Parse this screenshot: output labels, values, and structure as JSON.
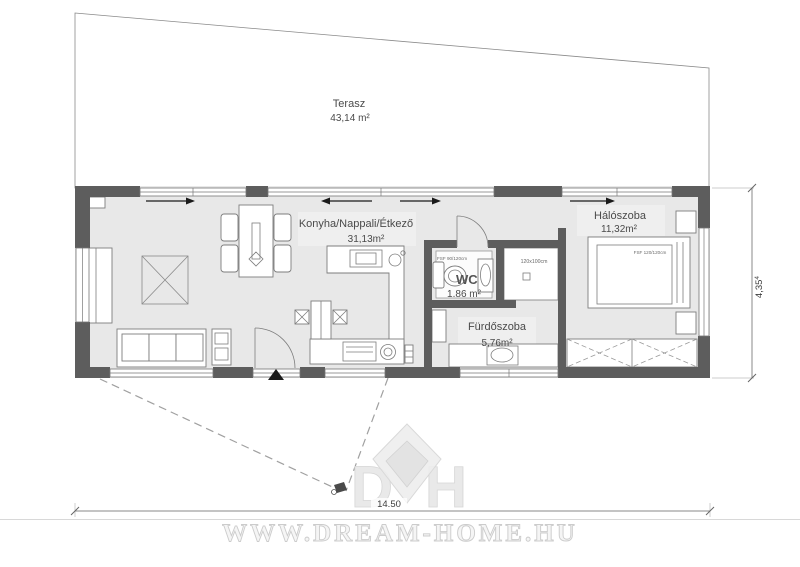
{
  "plan": {
    "terrace": {
      "name": "Terasz",
      "area": "43,14 m²"
    },
    "living": {
      "name": "Konyha/Nappali/Étkező",
      "area": "31,13m²"
    },
    "wc": {
      "name": "WC",
      "area": "1.86 m²",
      "window_label": "FSF 90/120cm"
    },
    "shower": {
      "label": "120x100cm"
    },
    "bathroom": {
      "name": "Fürdőszoba",
      "area": "5,76m²"
    },
    "bedroom": {
      "name": "Hálószoba",
      "area": "11,32m²",
      "bed_label": "FSF 120/120cm"
    }
  },
  "dimensions": {
    "width": "14.50",
    "depth": "4,35",
    "depth_sup": "4"
  },
  "branding": {
    "watermark": "WWW.DREAM-HOME.HU",
    "logo_left": "D",
    "logo_right": "H"
  },
  "colors": {
    "wall": "#5d5d5d",
    "floor": "#e8e8e8",
    "terrace": "#ebebeb",
    "outline": "#8a8a8a"
  }
}
